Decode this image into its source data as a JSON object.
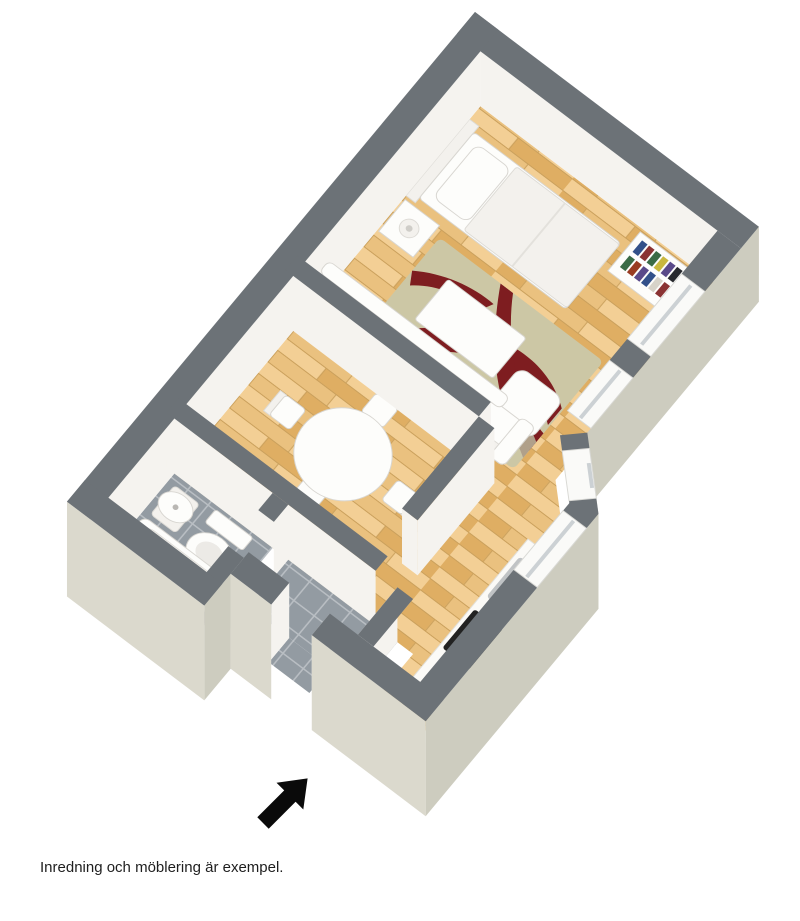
{
  "caption": "Inredning och möblering är exempel.",
  "colors": {
    "background": "#ffffff",
    "wall_top": "#6c7277",
    "wall_exterior": "#dbd9cd",
    "wall_exterior_dark": "#cdccbf",
    "wall_interior": "#f5f3ef",
    "floor_wood": "#eac17f",
    "floor_wood_light": "#f3cf95",
    "floor_wood_dark": "#dfae63",
    "plank_line": "#caa05c",
    "floor_tile": "#939ba2",
    "tile_grout": "#b9bec3",
    "rug": "#ccc7a5",
    "rug_red": "#7e1d20",
    "rug_tan": "#b0a08a",
    "steel": "#c0c3c5",
    "steel_dark": "#a9acae",
    "cooktop": "#222222",
    "window_glass": "#ccd1d4",
    "arrow": "#0a0a0a",
    "books": [
      "#33518a",
      "#8a3333",
      "#3a6b46",
      "#c9b83e",
      "#5a4a8a",
      "#27292e",
      "#b06030",
      "#2e6f8a",
      "#993c22",
      "#d7d3c9"
    ]
  },
  "plan": {
    "type": "3d-floor-plan",
    "view": "isometric top-down",
    "rooms": [
      {
        "name": "bedroom-living-room",
        "floor": "wood",
        "furniture": [
          "bed",
          "headboard",
          "pillow",
          "nightstand",
          "table-lamp",
          "bookshelf",
          "rug",
          "coffee-table",
          "pouf",
          "sofa"
        ]
      },
      {
        "name": "dining-room",
        "floor": "wood",
        "furniture": [
          "round-dining-table",
          "dining-chair-north",
          "dining-chair-west",
          "dining-chair-east",
          "dining-chair-south"
        ]
      },
      {
        "name": "bathroom",
        "floor": "gray-tile",
        "furniture": [
          "wash-basin",
          "toilet",
          "bathtub"
        ]
      },
      {
        "name": "hall",
        "floor": "gray-tile",
        "furniture": []
      },
      {
        "name": "kitchen",
        "floor": "wood",
        "furniture": [
          "kitchen-counter",
          "kitchen-sink",
          "cooktop"
        ]
      }
    ],
    "windows_count": 4,
    "entrance": "door opening in lower wall marked with black arrow"
  }
}
